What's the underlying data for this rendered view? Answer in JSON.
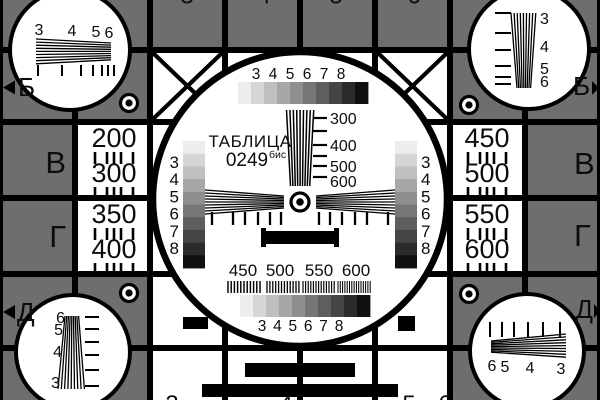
{
  "card": {
    "title": "ТАБЛИЦА",
    "number": "0249",
    "suffix": "бис"
  },
  "colors": {
    "bg": "#6e6e6e",
    "white": "#ffffff",
    "black": "#000000",
    "ink": "#0d0d0d",
    "grayscale_steps": [
      "#ededed",
      "#d6d6d6",
      "#bfbfbf",
      "#a7a7a7",
      "#8f8f8f",
      "#767676",
      "#5e5e5e",
      "#454545",
      "#2b2b2b",
      "#101010"
    ]
  },
  "labels": {
    "rows_left": [
      {
        "text": "Б",
        "marker": "◄"
      },
      {
        "text": "В"
      },
      {
        "text": "Г"
      },
      {
        "text": "Д",
        "marker": "◄"
      }
    ],
    "rows_right": [
      {
        "text": "Б",
        "marker": "►"
      },
      {
        "text": "В"
      },
      {
        "text": "Г"
      },
      {
        "text": "Д",
        "marker": "►"
      }
    ]
  },
  "scales": {
    "grayscale_digits": [
      "3",
      "4",
      "5",
      "6",
      "7",
      "8"
    ],
    "center_wedge_marks": [
      "300",
      "400",
      "500",
      "600"
    ],
    "burst_labels": [
      "450",
      "500",
      "550",
      "600"
    ],
    "left_cell_numbers": [
      "200",
      "300",
      "350",
      "400"
    ],
    "right_cell_numbers": [
      "450",
      "500",
      "550",
      "600"
    ],
    "corner_digits": {
      "top_left": [
        "3",
        "4",
        "5",
        "6"
      ],
      "top_right": [
        "3",
        "4",
        "5",
        "6"
      ],
      "bottom_left": [
        "6",
        "5",
        "4",
        "3"
      ],
      "bottom_right": [
        "6",
        "5",
        "4",
        "3"
      ]
    },
    "edge_digit_tips_top": [
      "3",
      "4",
      "5",
      "6"
    ],
    "edge_digit_tips_bottom": [
      "3",
      "4",
      "5",
      "6"
    ]
  }
}
